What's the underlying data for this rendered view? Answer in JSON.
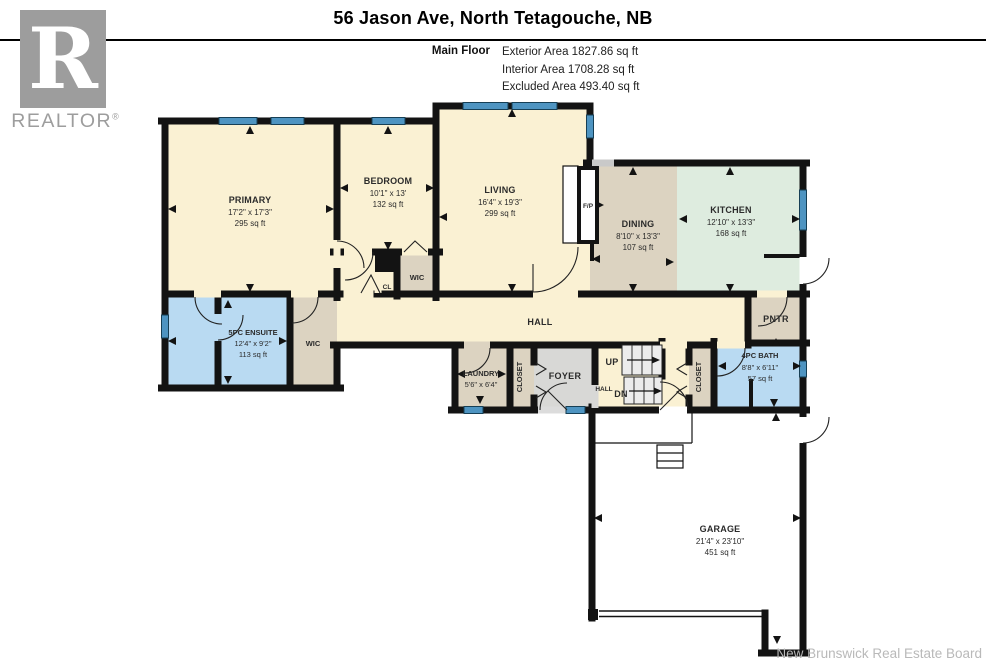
{
  "header": {
    "title": "56 Jason Ave, North Tetagouche, NB",
    "floor_label": "Main Floor",
    "stats": [
      "Exterior Area 1827.86 sq ft",
      "Interior Area 1708.28 sq ft",
      "Excluded Area 493.40 sq ft"
    ]
  },
  "logo": {
    "letter": "R",
    "wordmark": "REALTOR",
    "registered": "®"
  },
  "footer": {
    "credit": "New Brunswick Real Estate Board"
  },
  "colors": {
    "wall": "#131313",
    "room_cream": "#FAF1D3",
    "room_tan": "#DCD3C1",
    "room_mint": "#DEECDF",
    "room_blue": "#B9DAF2",
    "room_gray": "#D8D8D6",
    "window_blue": "#4E94C1",
    "stairs_gray": "#ECECEC",
    "logo_gray": "#9d9d9d"
  },
  "rooms": [
    {
      "id": "primary",
      "name": "PRIMARY",
      "dims": "17'2\" x 17'3\"",
      "area": "295 sq ft"
    },
    {
      "id": "bedroom",
      "name": "BEDROOM",
      "dims": "10'1\" x 13'",
      "area": "132 sq ft"
    },
    {
      "id": "living",
      "name": "LIVING",
      "dims": "16'4\" x 19'3\"",
      "area": "299 sq ft"
    },
    {
      "id": "dining",
      "name": "DINING",
      "dims": "8'10\" x 13'3\"",
      "area": "107 sq ft"
    },
    {
      "id": "kitchen",
      "name": "KITCHEN",
      "dims": "12'10\" x 13'3\"",
      "area": "168 sq ft"
    },
    {
      "id": "ensuite",
      "name": "5PC ENSUITE",
      "dims": "12'4\" x 9'2\"",
      "area": "113 sq ft"
    },
    {
      "id": "bath",
      "name": "4PC BATH",
      "dims": "8'8\" x 6'11\"",
      "area": "57 sq ft"
    },
    {
      "id": "laundry",
      "name": "LAUNDRY",
      "dims": "5'6\" x 6'4\"",
      "area": ""
    },
    {
      "id": "garage",
      "name": "GARAGE",
      "dims": "21'4\" x 23'10\"",
      "area": "451 sq ft"
    }
  ],
  "labels": {
    "hall": "HALL",
    "hall_small": "HALL",
    "foyer": "FOYER",
    "pantry": "PNTR",
    "wic_ensuite": "WIC",
    "wic_bedroom": "WIC",
    "closet_1": "CLOSET",
    "closet_2": "CLOSET",
    "cl": "CL",
    "fireplace": "F/P",
    "up": "UP",
    "down": "DN"
  }
}
